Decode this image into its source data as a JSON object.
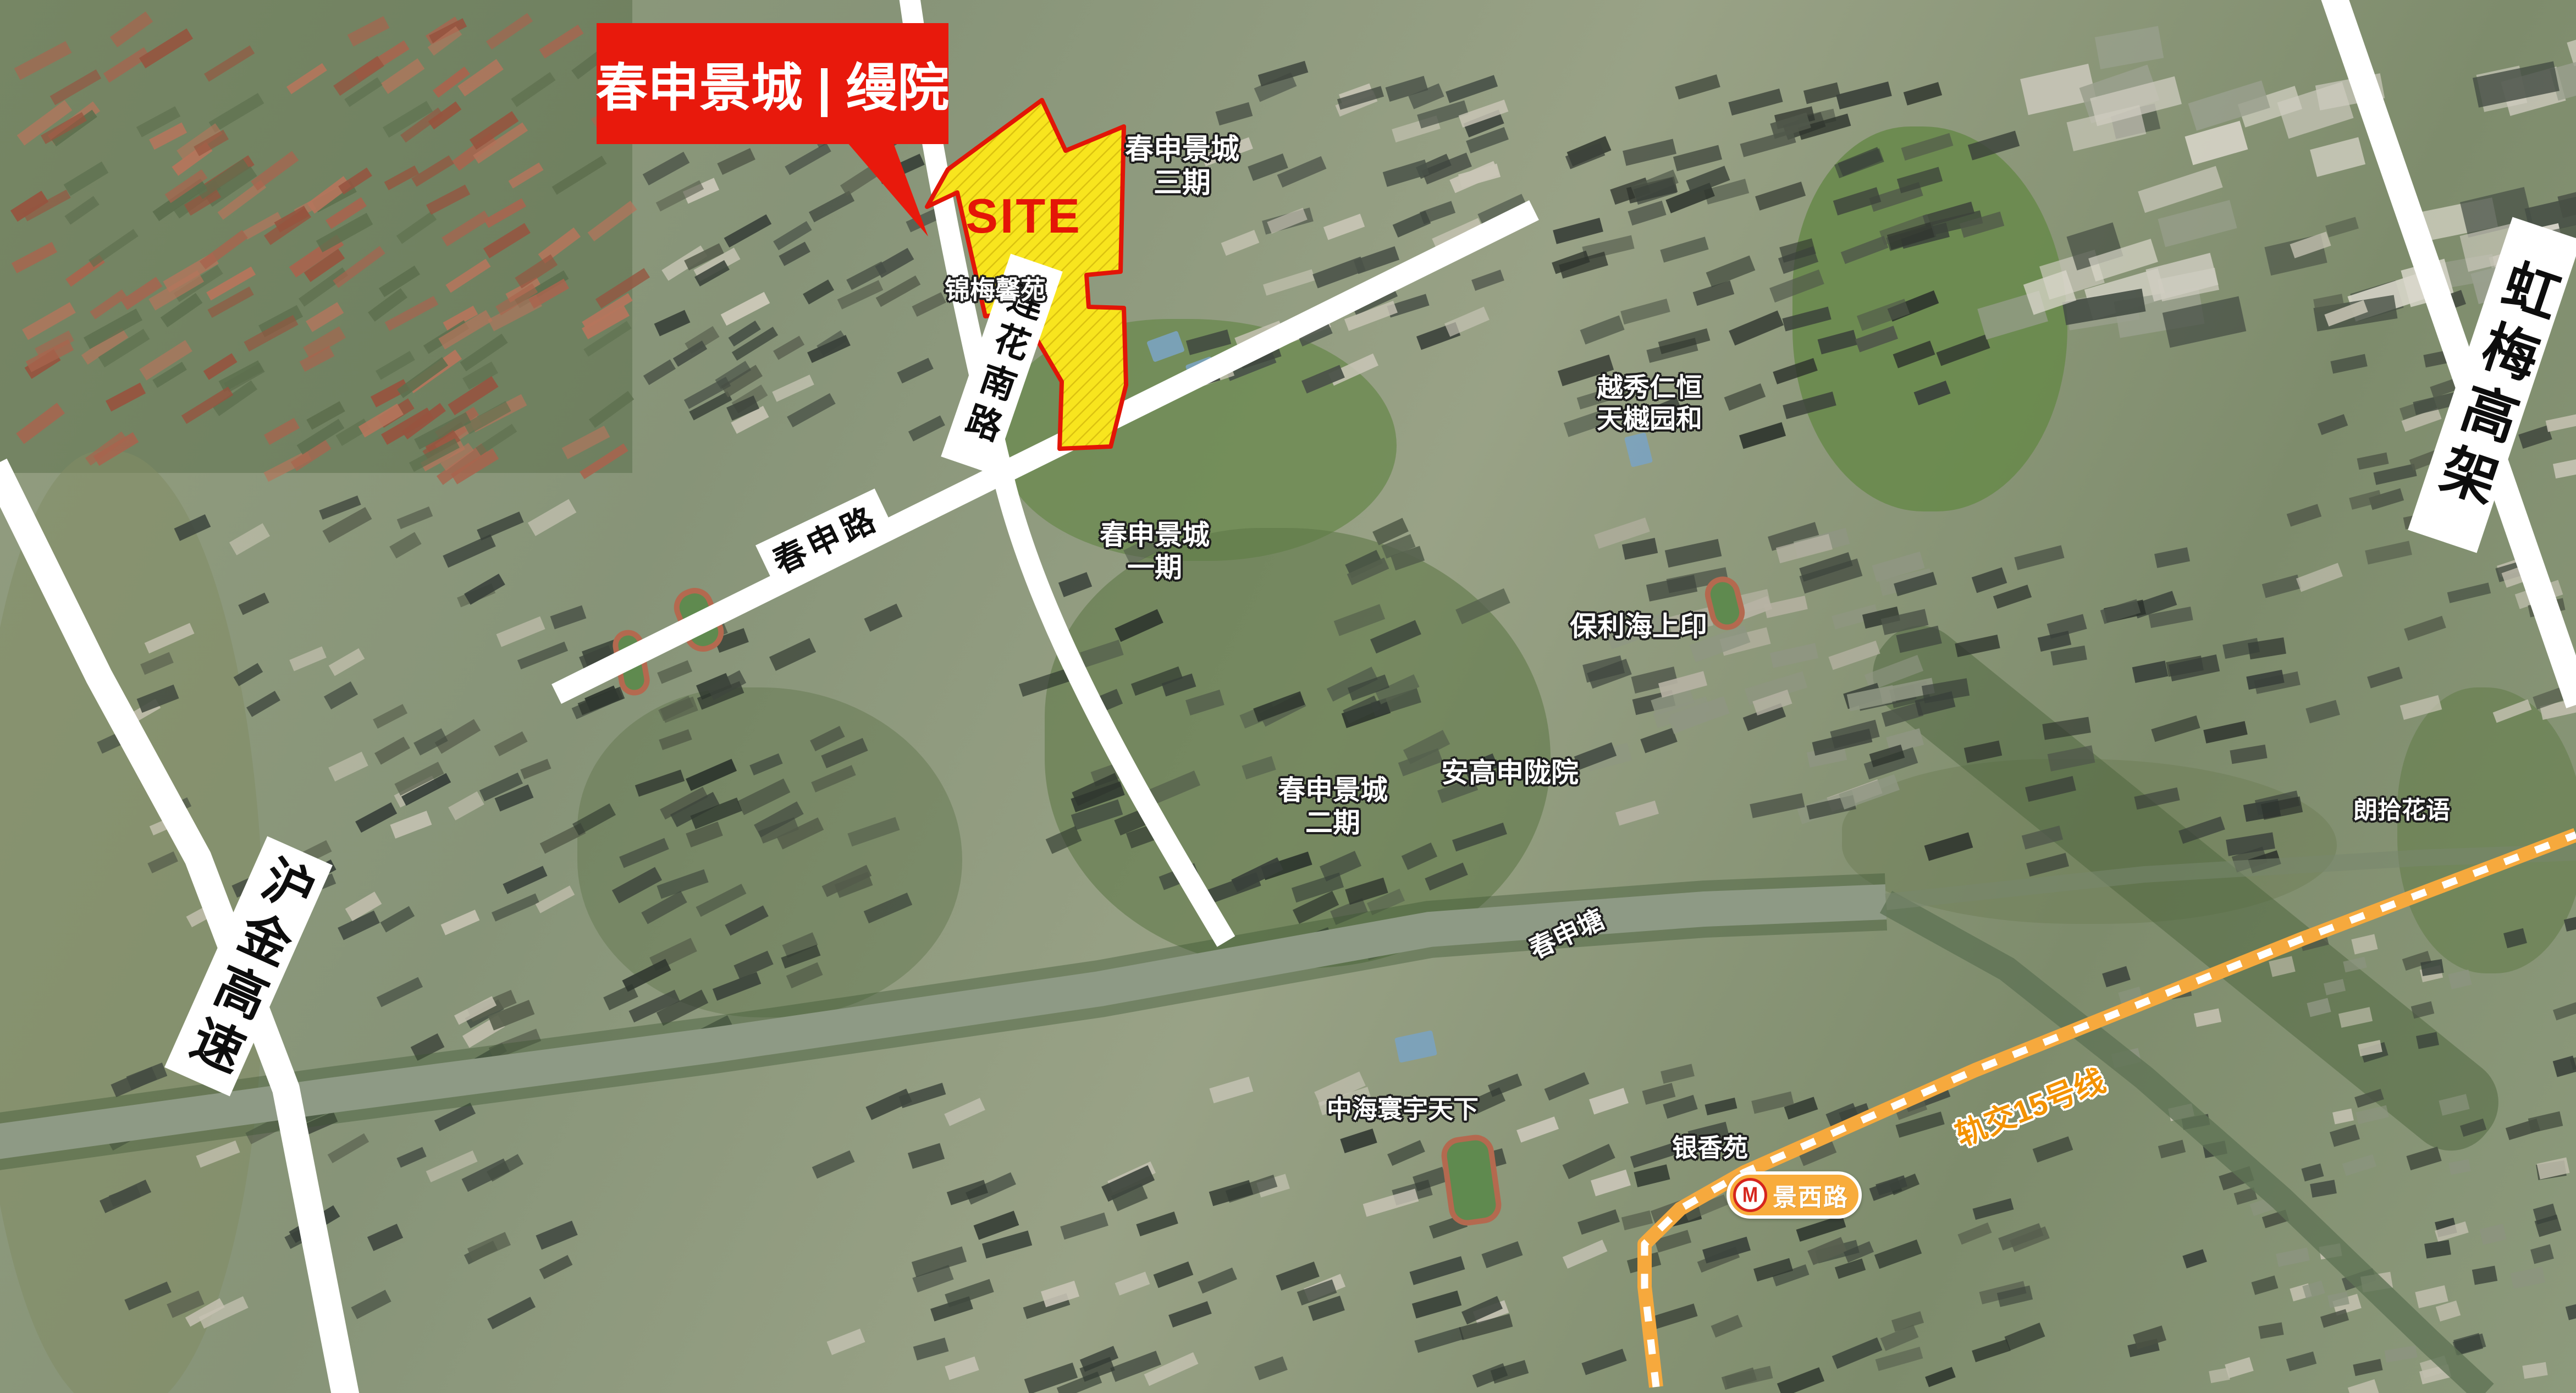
{
  "banner": {
    "title": "春申景城 | 缦院"
  },
  "site": {
    "label": "SITE"
  },
  "places": {
    "csjc3_line1": "春申景城",
    "csjc3_line2": "三期",
    "jinmei": "锦梅馨苑",
    "csjc1_line1": "春申景城",
    "csjc1_line2": "一期",
    "yuexiu_line1": "越秀仁恒",
    "yuexiu_line2": "天樾园和",
    "baoli": "保利海上印",
    "angao": "安高申陇院",
    "csjc2_line1": "春申景城",
    "csjc2_line2": "二期",
    "langshi": "朗拾花语",
    "zhonghai": "中海寰宇天下",
    "yinxiang": "银香苑"
  },
  "roads": {
    "lianhua": "莲花南路",
    "chunshen": "春申路",
    "hujin": "沪金高速",
    "hongmei": "虹梅高架"
  },
  "water": {
    "chunshentang": "春申塘"
  },
  "metro": {
    "line": "轨交15号线",
    "station": "景西路",
    "logo": "M"
  },
  "colors": {
    "accent_red": "#e8190c",
    "site_yellow": "#f8e51e",
    "site_border": "#e01507",
    "metro_orange": "#f6a93d",
    "road_white": "#ffffff"
  }
}
